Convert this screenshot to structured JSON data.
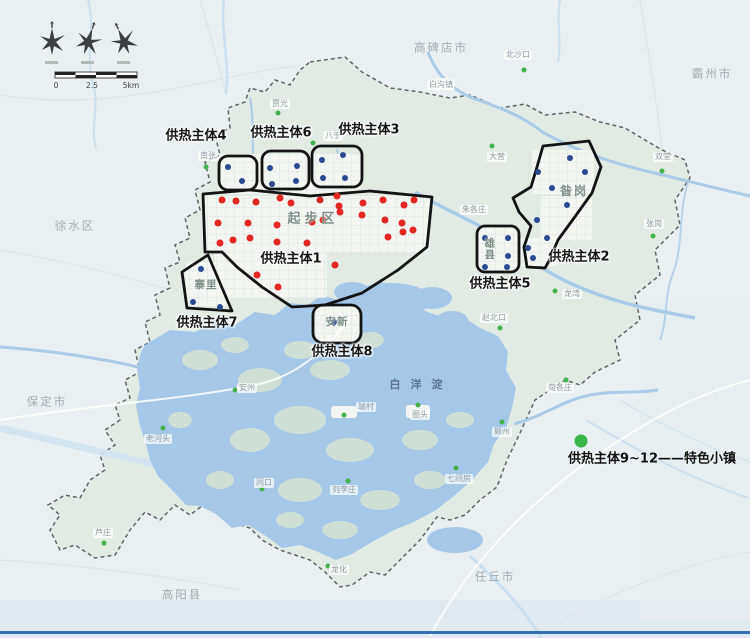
{
  "page": {
    "bottom_border_color": "#3a6db8"
  },
  "scale_bar": {
    "ticks": [
      "0",
      "2.5",
      "5km"
    ]
  },
  "legend": {
    "label": "供热主体9~12——特色小镇",
    "dot_color": "#3cb54a"
  },
  "lake": {
    "name": "白洋淀"
  },
  "zones": [
    {
      "label": "供热主体1",
      "center": [
        291,
        259
      ]
    },
    {
      "label": "供热主体2",
      "center": [
        579,
        257
      ]
    },
    {
      "label": "供热主体3",
      "center": [
        369,
        130
      ]
    },
    {
      "label": "供热主体4",
      "center": [
        196,
        136
      ]
    },
    {
      "label": "供热主体5",
      "center": [
        500,
        284
      ]
    },
    {
      "label": "供热主体6",
      "center": [
        281,
        133
      ]
    },
    {
      "label": "供热主体7",
      "center": [
        207,
        323
      ]
    },
    {
      "label": "供热主体8",
      "center": [
        342,
        352
      ]
    }
  ],
  "areas": [
    {
      "name": "起步区",
      "center": [
        313,
        219
      ],
      "size": 13,
      "spacing": 4,
      "vertical": false
    },
    {
      "name": "昝岗",
      "center": [
        574,
        191
      ],
      "size": 12,
      "spacing": 2,
      "vertical": false
    },
    {
      "name": "安新",
      "center": [
        337,
        322
      ],
      "size": 10.5,
      "spacing": 1,
      "vertical": false
    },
    {
      "name": "寨里",
      "center": [
        206,
        285
      ],
      "size": 10.5,
      "spacing": 1,
      "vertical": false
    },
    {
      "name": "雄县",
      "center": [
        489,
        249
      ],
      "size": 10.5,
      "spacing": 1,
      "vertical": true
    }
  ],
  "cities": [
    {
      "name": "高碑店市",
      "center": [
        441,
        48
      ]
    },
    {
      "name": "霸州市",
      "center": [
        712,
        74
      ]
    },
    {
      "name": "徐水区",
      "center": [
        75,
        226
      ]
    },
    {
      "name": "保定市",
      "center": [
        47,
        402
      ]
    },
    {
      "name": "高阳县",
      "center": [
        182,
        595
      ]
    },
    {
      "name": "任丘市",
      "center": [
        495,
        577
      ]
    }
  ],
  "towns": [
    {
      "name": "北沙口",
      "center": [
        518,
        55
      ],
      "dot": [
        524,
        70
      ]
    },
    {
      "name": "白沟镇",
      "center": [
        441,
        85
      ]
    },
    {
      "name": "贾光",
      "center": [
        280,
        104
      ],
      "dot": [
        278,
        113
      ]
    },
    {
      "name": "南张",
      "center": [
        208,
        156
      ],
      "dot": [
        206,
        167
      ]
    },
    {
      "name": "八于",
      "center": [
        333,
        136
      ],
      "dot": [
        313,
        143
      ]
    },
    {
      "name": "大营",
      "center": [
        497,
        157
      ],
      "dot": [
        492,
        146
      ]
    },
    {
      "name": "双堂",
      "center": [
        663,
        157
      ],
      "dot": [
        662,
        171
      ]
    },
    {
      "name": "朱各庄",
      "center": [
        474,
        210
      ]
    },
    {
      "name": "张岗",
      "center": [
        654,
        224
      ],
      "dot": [
        653,
        236
      ]
    },
    {
      "name": "龙湾",
      "center": [
        572,
        294
      ],
      "dot": [
        555,
        291
      ]
    },
    {
      "name": "赵北口",
      "center": [
        494,
        318
      ],
      "dot": [
        500,
        328
      ]
    },
    {
      "name": "安州",
      "center": [
        247,
        388
      ],
      "dot": [
        235,
        390
      ]
    },
    {
      "name": "老河头",
      "center": [
        158,
        439
      ],
      "dot": [
        163,
        428
      ]
    },
    {
      "name": "端村",
      "center": [
        366,
        407
      ],
      "dot": [
        344,
        415
      ]
    },
    {
      "name": "圈头",
      "center": [
        420,
        415
      ],
      "dot": [
        418,
        405
      ]
    },
    {
      "name": "同口",
      "center": [
        264,
        483
      ],
      "dot": [
        262,
        489
      ]
    },
    {
      "name": "刘李庄",
      "center": [
        344,
        490
      ],
      "dot": [
        348,
        481
      ]
    },
    {
      "name": "七间房",
      "center": [
        459,
        479
      ],
      "dot": [
        456,
        468
      ]
    },
    {
      "name": "鄚州",
      "center": [
        502,
        432
      ],
      "dot": [
        502,
        422
      ]
    },
    {
      "name": "苟各庄",
      "center": [
        560,
        388
      ],
      "dot": [
        566,
        380
      ]
    },
    {
      "name": "龙化",
      "center": [
        339,
        570
      ],
      "dot": [
        328,
        566
      ]
    },
    {
      "name": "芦庄",
      "center": [
        103,
        533
      ],
      "dot": [
        104,
        543
      ]
    }
  ],
  "dots": {
    "red": [
      [
        222,
        200
      ],
      [
        236,
        201
      ],
      [
        256,
        202
      ],
      [
        280,
        198
      ],
      [
        291,
        203
      ],
      [
        320,
        200
      ],
      [
        337,
        196
      ],
      [
        339,
        206
      ],
      [
        363,
        203
      ],
      [
        383,
        200
      ],
      [
        404,
        205
      ],
      [
        414,
        200
      ],
      [
        218,
        223
      ],
      [
        248,
        223
      ],
      [
        277,
        225
      ],
      [
        312,
        222
      ],
      [
        323,
        220
      ],
      [
        340,
        212
      ],
      [
        362,
        215
      ],
      [
        385,
        220
      ],
      [
        402,
        223
      ],
      [
        413,
        230
      ],
      [
        220,
        243
      ],
      [
        233,
        240
      ],
      [
        250,
        238
      ],
      [
        277,
        242
      ],
      [
        307,
        243
      ],
      [
        388,
        237
      ],
      [
        403,
        232
      ],
      [
        335,
        265
      ],
      [
        257,
        275
      ],
      [
        278,
        287
      ]
    ],
    "blue": [
      [
        228,
        167
      ],
      [
        242,
        181
      ],
      [
        270,
        168
      ],
      [
        297,
        166
      ],
      [
        272,
        184
      ],
      [
        296,
        181
      ],
      [
        322,
        160
      ],
      [
        343,
        155
      ],
      [
        323,
        178
      ],
      [
        345,
        178
      ],
      [
        201,
        269
      ],
      [
        193,
        302
      ],
      [
        220,
        307
      ],
      [
        334,
        322
      ],
      [
        485,
        238
      ],
      [
        508,
        238
      ],
      [
        508,
        256
      ],
      [
        485,
        267
      ],
      [
        507,
        267
      ],
      [
        570,
        158
      ],
      [
        538,
        172
      ],
      [
        585,
        172
      ],
      [
        552,
        188
      ],
      [
        567,
        205
      ],
      [
        537,
        220
      ],
      [
        547,
        238
      ],
      [
        528,
        248
      ],
      [
        533,
        258
      ]
    ]
  },
  "colors": {
    "red_dot": "#e42722",
    "blue_dot": "#2b4a8f",
    "green_dot": "#44b14d",
    "zone_outline": "#131313",
    "boundary_fill": "#e2ebe3",
    "water": "#a5c8e8",
    "outside": "#eaeff1"
  }
}
